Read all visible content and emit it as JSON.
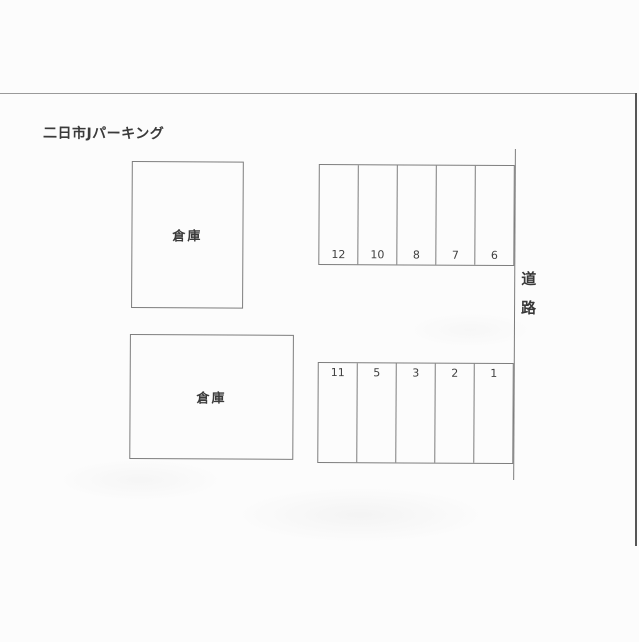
{
  "page": {
    "title": "二日市Jパーキング"
  },
  "warehouses": [
    {
      "label": "倉庫"
    },
    {
      "label": "倉庫"
    }
  ],
  "parking": {
    "top_row": [
      "12",
      "10",
      "8",
      "7",
      "6"
    ],
    "bottom_row": [
      "11",
      "5",
      "3",
      "2",
      "1"
    ]
  },
  "road": {
    "label_chars": [
      "道",
      "路"
    ]
  },
  "colors": {
    "background": "#fcfcfc",
    "diagram_line": "#7d7d7d",
    "page_edge": "#565656",
    "text": "#3a3a3a"
  }
}
